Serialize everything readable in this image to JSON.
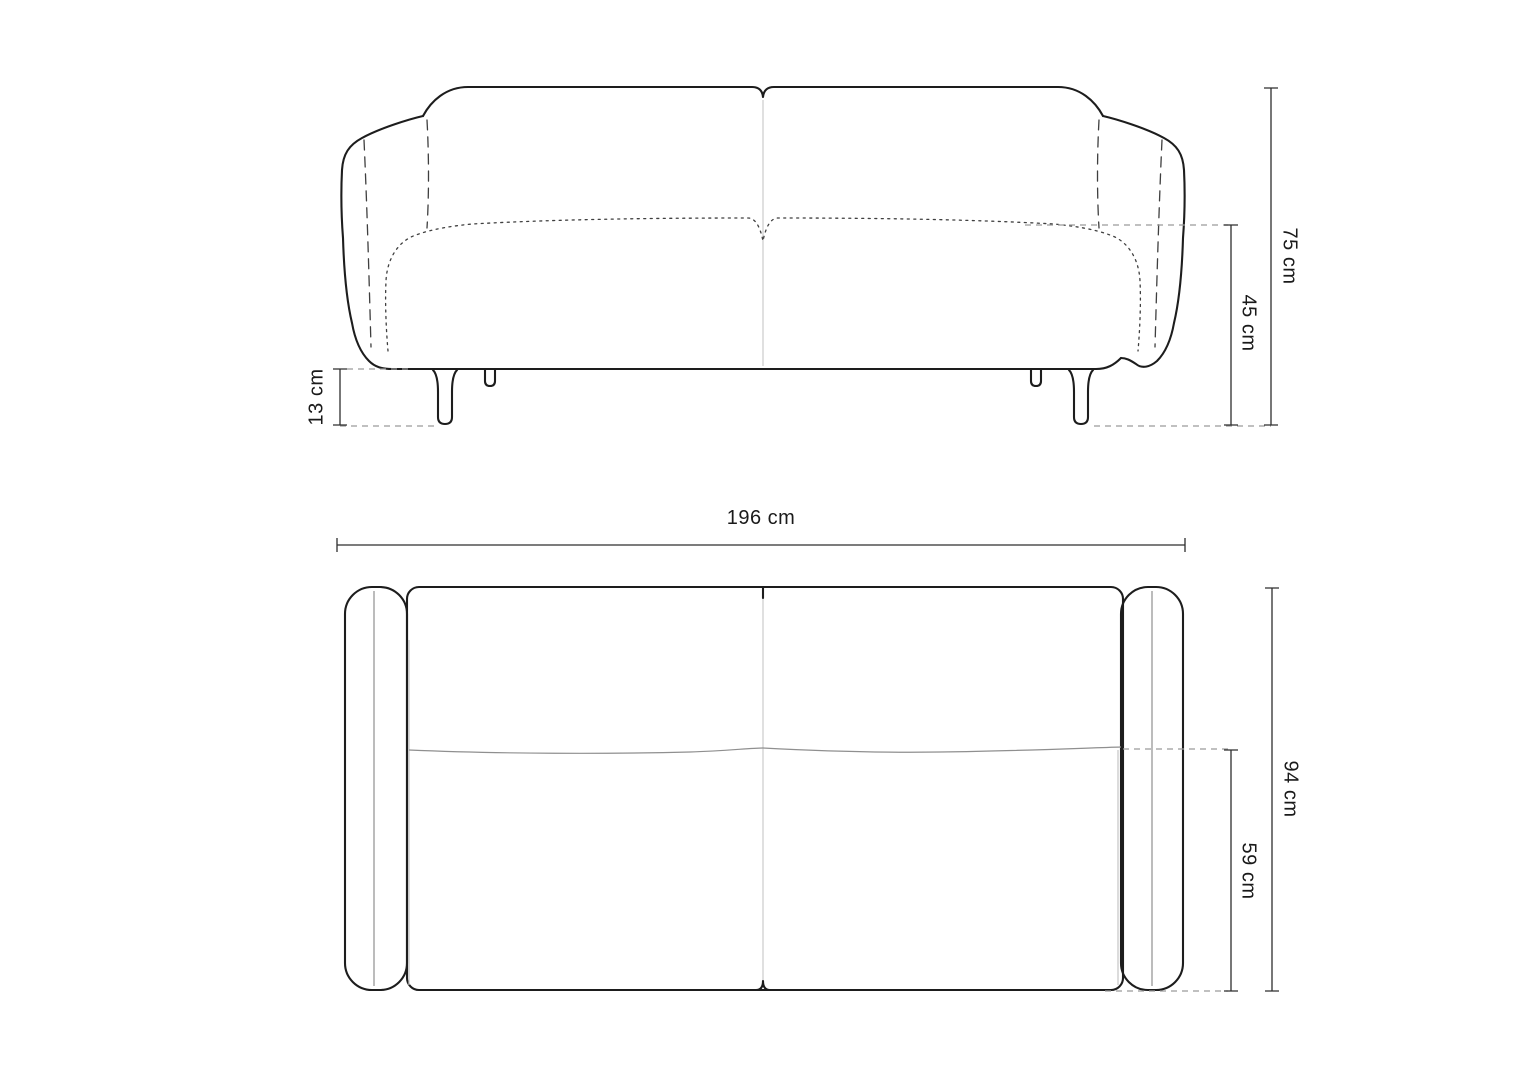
{
  "page": {
    "background": "#ffffff",
    "description": "Technical dimension drawing of a two-seat sofa, front elevation and top (plan) view"
  },
  "colors": {
    "outline": "#1d1d1d",
    "dimension_line": "#2e2e2e",
    "extension_dashed": "#9a9a9a",
    "seam_light": "#d2d2d2",
    "text": "#1a1a1a"
  },
  "units": "cm",
  "views": {
    "front": {
      "name": "front-elevation",
      "dimensions": [
        {
          "id": "total_height",
          "label": "75 cm",
          "value_cm": 75,
          "orientation": "vertical"
        },
        {
          "id": "seat_height",
          "label": "45 cm",
          "value_cm": 45,
          "orientation": "vertical"
        },
        {
          "id": "leg_height",
          "label": "13 cm",
          "value_cm": 13,
          "orientation": "vertical"
        }
      ]
    },
    "top": {
      "name": "top-plan",
      "dimensions": [
        {
          "id": "total_width",
          "label": "196 cm",
          "value_cm": 196,
          "orientation": "horizontal"
        },
        {
          "id": "total_depth",
          "label": "94 cm",
          "value_cm": 94,
          "orientation": "vertical"
        },
        {
          "id": "seat_depth",
          "label": "59 cm",
          "value_cm": 59,
          "orientation": "vertical"
        }
      ]
    }
  }
}
